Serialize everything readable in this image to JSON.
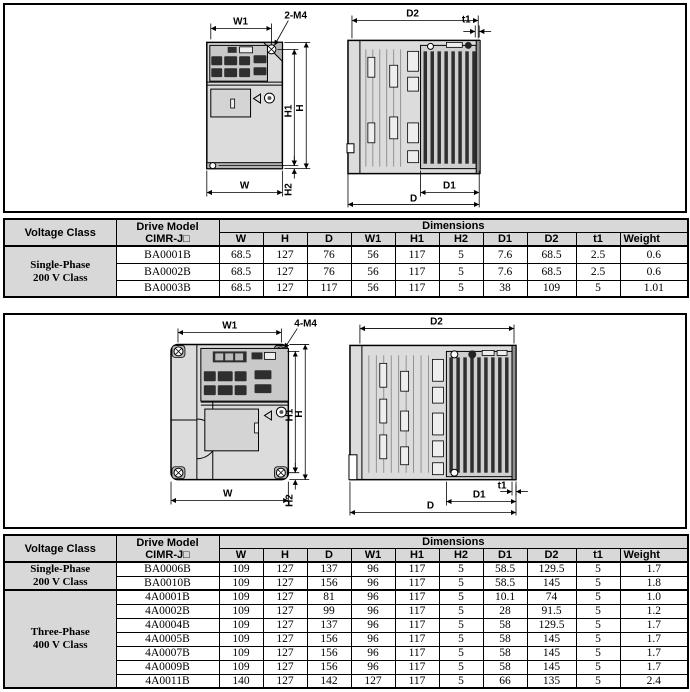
{
  "colors": {
    "table_header_bg": "#d8d8d8",
    "drawing_fill": "#dcdcdc",
    "line": "#000000"
  },
  "figure1": {
    "labels": {
      "w1": "W1",
      "m4": "2-M4",
      "h1": "H1",
      "h": "H",
      "h2": "H2",
      "w": "W",
      "d2": "D2",
      "t1": "t1",
      "d1": "D1",
      "d": "D"
    }
  },
  "figure2": {
    "labels": {
      "w1": "W1",
      "m4": "4-M4",
      "h1": "H1",
      "h": "H",
      "h2": "H2",
      "w": "W",
      "d2": "D2",
      "t1": "t1",
      "d1": "D1",
      "d": "D"
    }
  },
  "table1": {
    "header": {
      "voltage_class": "Voltage Class",
      "drive_model_line1": "Drive Model",
      "drive_model_line2": "CIMR-J□",
      "dimensions": "Dimensions",
      "columns": [
        "W",
        "H",
        "D",
        "W1",
        "H1",
        "H2",
        "D1",
        "D2",
        "t1",
        "Weight"
      ]
    },
    "groups": [
      {
        "voltage_class_line1": "Single-Phase",
        "voltage_class_line2": "200 V Class",
        "rows": [
          {
            "model": "BA0001B",
            "values": [
              "68.5",
              "127",
              "76",
              "56",
              "117",
              "5",
              "7.6",
              "68.5",
              "2.5",
              "0.6"
            ]
          },
          {
            "model": "BA0002B",
            "values": [
              "68.5",
              "127",
              "76",
              "56",
              "117",
              "5",
              "7.6",
              "68.5",
              "2.5",
              "0.6"
            ]
          },
          {
            "model": "BA0003B",
            "values": [
              "68.5",
              "127",
              "117",
              "56",
              "117",
              "5",
              "38",
              "109",
              "5",
              "1.01"
            ]
          }
        ]
      }
    ]
  },
  "table2": {
    "header": {
      "voltage_class": "Voltage Class",
      "drive_model_line1": "Drive Model",
      "drive_model_line2": "CIMR-J□",
      "dimensions": "Dimensions",
      "columns": [
        "W",
        "H",
        "D",
        "W1",
        "H1",
        "H2",
        "D1",
        "D2",
        "t1",
        "Weight"
      ]
    },
    "groups": [
      {
        "voltage_class_line1": "Single-Phase",
        "voltage_class_line2": "200 V Class",
        "rows": [
          {
            "model": "BA0006B",
            "values": [
              "109",
              "127",
              "137",
              "96",
              "117",
              "5",
              "58.5",
              "129.5",
              "5",
              "1.7"
            ]
          },
          {
            "model": "BA0010B",
            "values": [
              "109",
              "127",
              "156",
              "96",
              "117",
              "5",
              "58.5",
              "145",
              "5",
              "1.8"
            ]
          }
        ]
      },
      {
        "voltage_class_line1": "Three-Phase",
        "voltage_class_line2": "400 V Class",
        "rows": [
          {
            "model": "4A0001B",
            "values": [
              "109",
              "127",
              "81",
              "96",
              "117",
              "5",
              "10.1",
              "74",
              "5",
              "1.0"
            ]
          },
          {
            "model": "4A0002B",
            "values": [
              "109",
              "127",
              "99",
              "96",
              "117",
              "5",
              "28",
              "91.5",
              "5",
              "1.2"
            ]
          },
          {
            "model": "4A0004B",
            "values": [
              "109",
              "127",
              "137",
              "96",
              "117",
              "5",
              "58",
              "129.5",
              "5",
              "1.7"
            ]
          },
          {
            "model": "4A0005B",
            "values": [
              "109",
              "127",
              "156",
              "96",
              "117",
              "5",
              "58",
              "145",
              "5",
              "1.7"
            ]
          },
          {
            "model": "4A0007B",
            "values": [
              "109",
              "127",
              "156",
              "96",
              "117",
              "5",
              "58",
              "145",
              "5",
              "1.7"
            ]
          },
          {
            "model": "4A0009B",
            "values": [
              "109",
              "127",
              "156",
              "96",
              "117",
              "5",
              "58",
              "145",
              "5",
              "1.7"
            ]
          },
          {
            "model": "4A0011B",
            "values": [
              "140",
              "127",
              "142",
              "127",
              "117",
              "5",
              "66",
              "135",
              "5",
              "2.4"
            ]
          }
        ]
      }
    ]
  }
}
